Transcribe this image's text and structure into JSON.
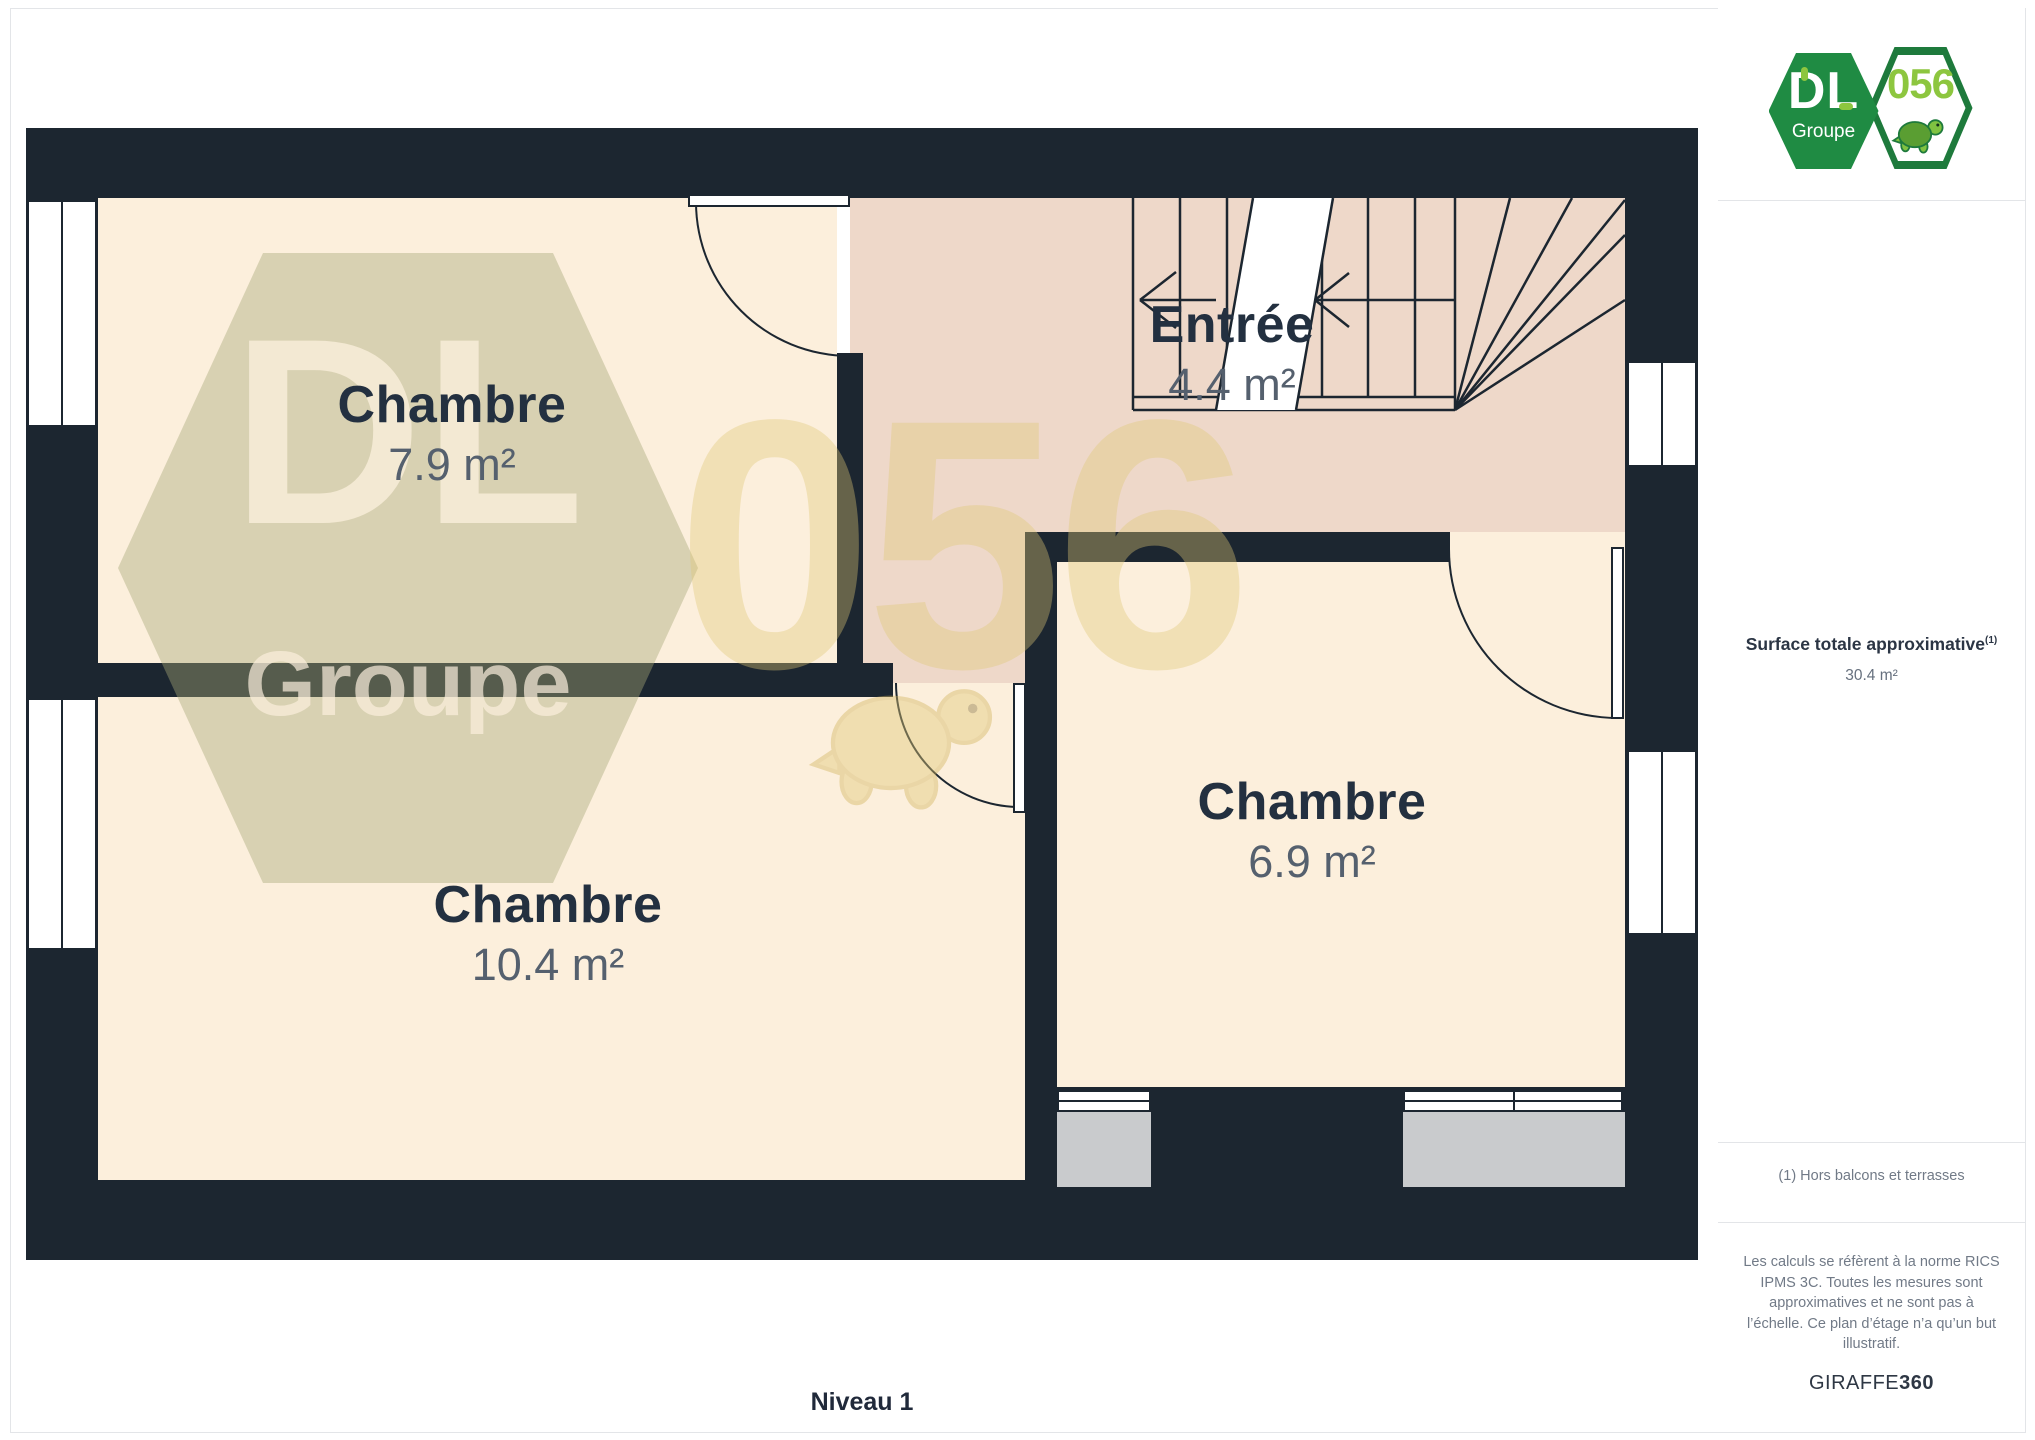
{
  "page": {
    "level_label": "Niveau 1"
  },
  "logo": {
    "brand": "DL",
    "brand_sub": "Groupe",
    "badge": "056"
  },
  "watermark": {
    "brand": "DL",
    "brand_sub": "Groupe",
    "badge": "056"
  },
  "rooms": [
    {
      "name": "Chambre",
      "area": "7.9 m²"
    },
    {
      "name": "Entrée",
      "area": "4.4 m²"
    },
    {
      "name": "Chambre",
      "area": "10.4 m²"
    },
    {
      "name": "Chambre",
      "area": "6.9 m²"
    }
  ],
  "sidebar": {
    "surface_title": "Surface totale approximative",
    "surface_sup": "(1)",
    "surface_value": "30.4 m²",
    "footnote": "(1) Hors balcons et terrasses",
    "disclaimer": "Les calculs se réfèrent à la norme RICS IPMS 3C. Toutes les mesures sont approximatives et ne sont pas à l’échelle. Ce plan d’étage n’a qu’un but illustratif.",
    "brand_left": "GIRAFFE",
    "brand_right": "360"
  },
  "colors": {
    "wall": "#1c2630",
    "room_floor": "#fcefdc",
    "hall_floor": "#eed8c9",
    "sill_gray": "#c9cbcd",
    "logo_green": "#1f8b43",
    "logo_light_green": "#8dc63f",
    "label_dark": "#233040",
    "label_gray": "#55606e",
    "watermark_olive": "#ddddc6",
    "watermark_yellow": "#efe1b4"
  }
}
